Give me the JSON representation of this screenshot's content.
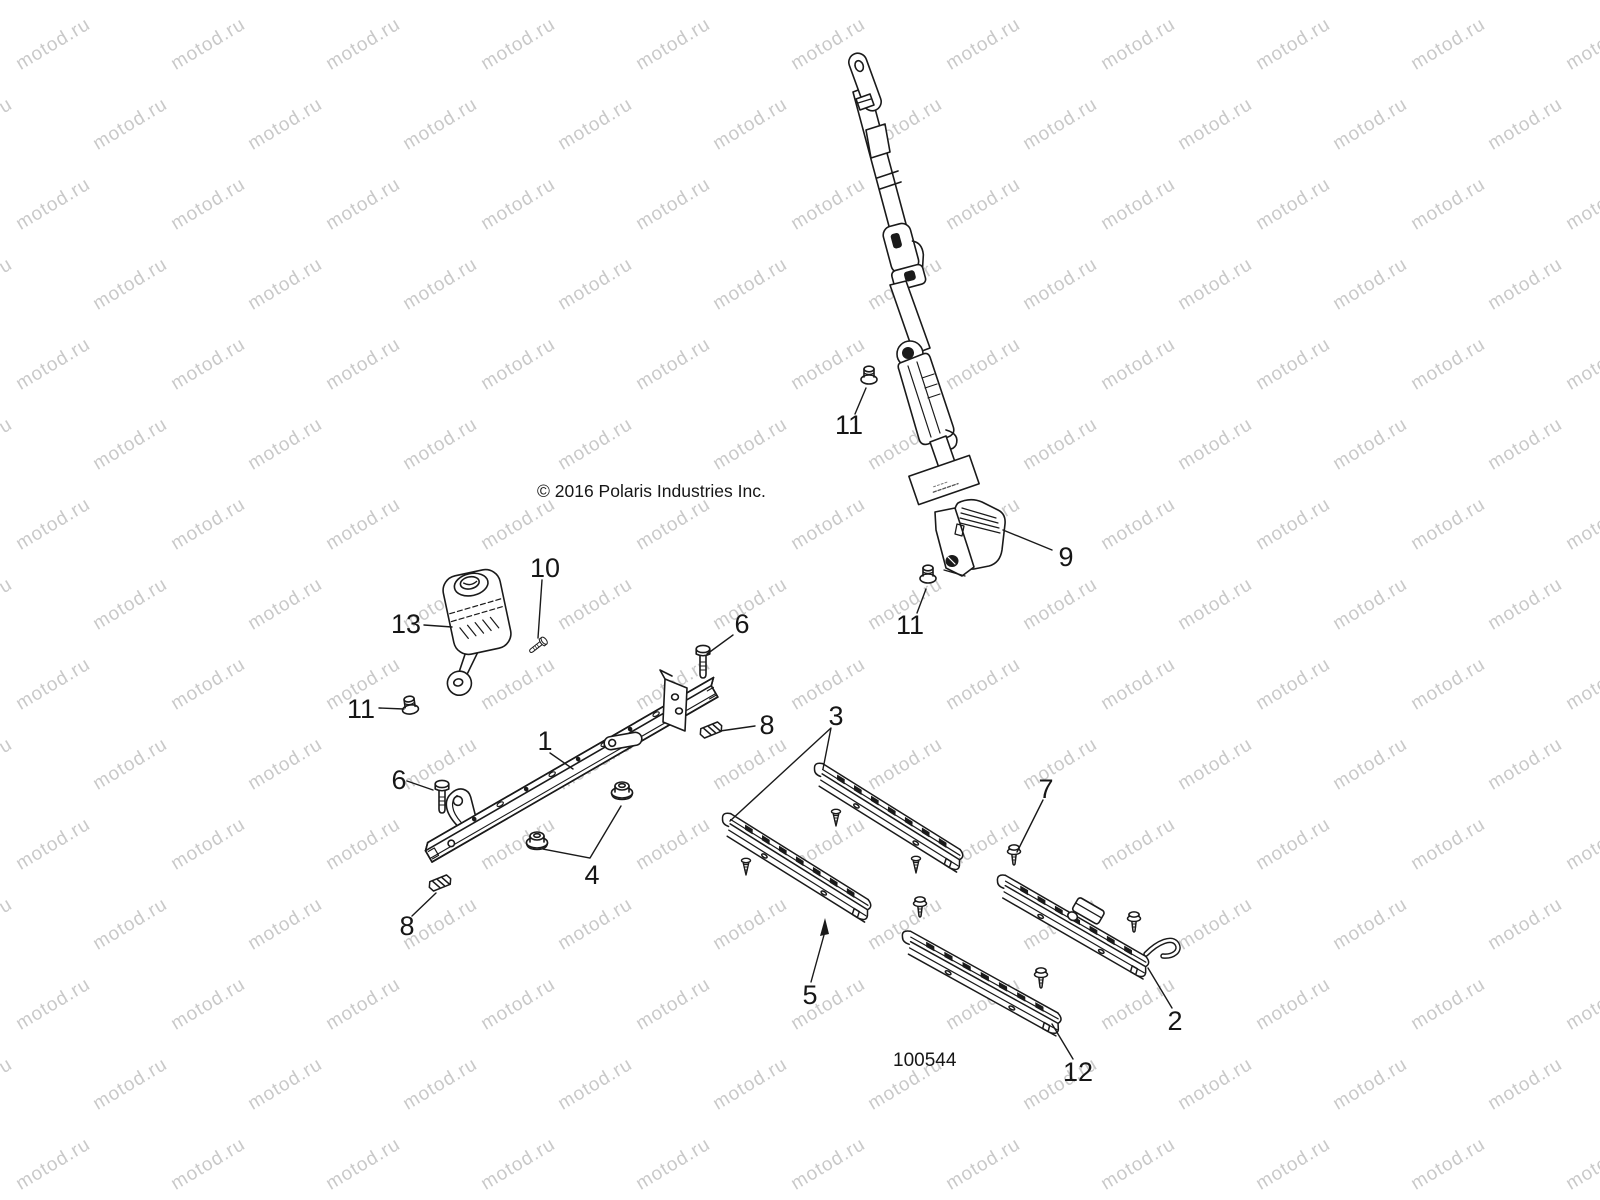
{
  "watermark": {
    "text": "motod.ru",
    "color": "#c9c9c9",
    "font_size_px": 19,
    "angle_deg": -31
  },
  "copyright": "© 2016 Polaris Industries Inc.",
  "figure_number": "100544",
  "line_color": "#1a1a1a",
  "callouts": [
    {
      "label": "13"
    },
    {
      "label": "10"
    },
    {
      "label": "11"
    },
    {
      "label": "6"
    },
    {
      "label": "6"
    },
    {
      "label": "1"
    },
    {
      "label": "8"
    },
    {
      "label": "8"
    },
    {
      "label": "4"
    },
    {
      "label": "3"
    },
    {
      "label": "5"
    },
    {
      "label": "7"
    },
    {
      "label": "2"
    },
    {
      "label": "12"
    },
    {
      "label": "9"
    },
    {
      "label": "11"
    },
    {
      "label": "11"
    }
  ]
}
